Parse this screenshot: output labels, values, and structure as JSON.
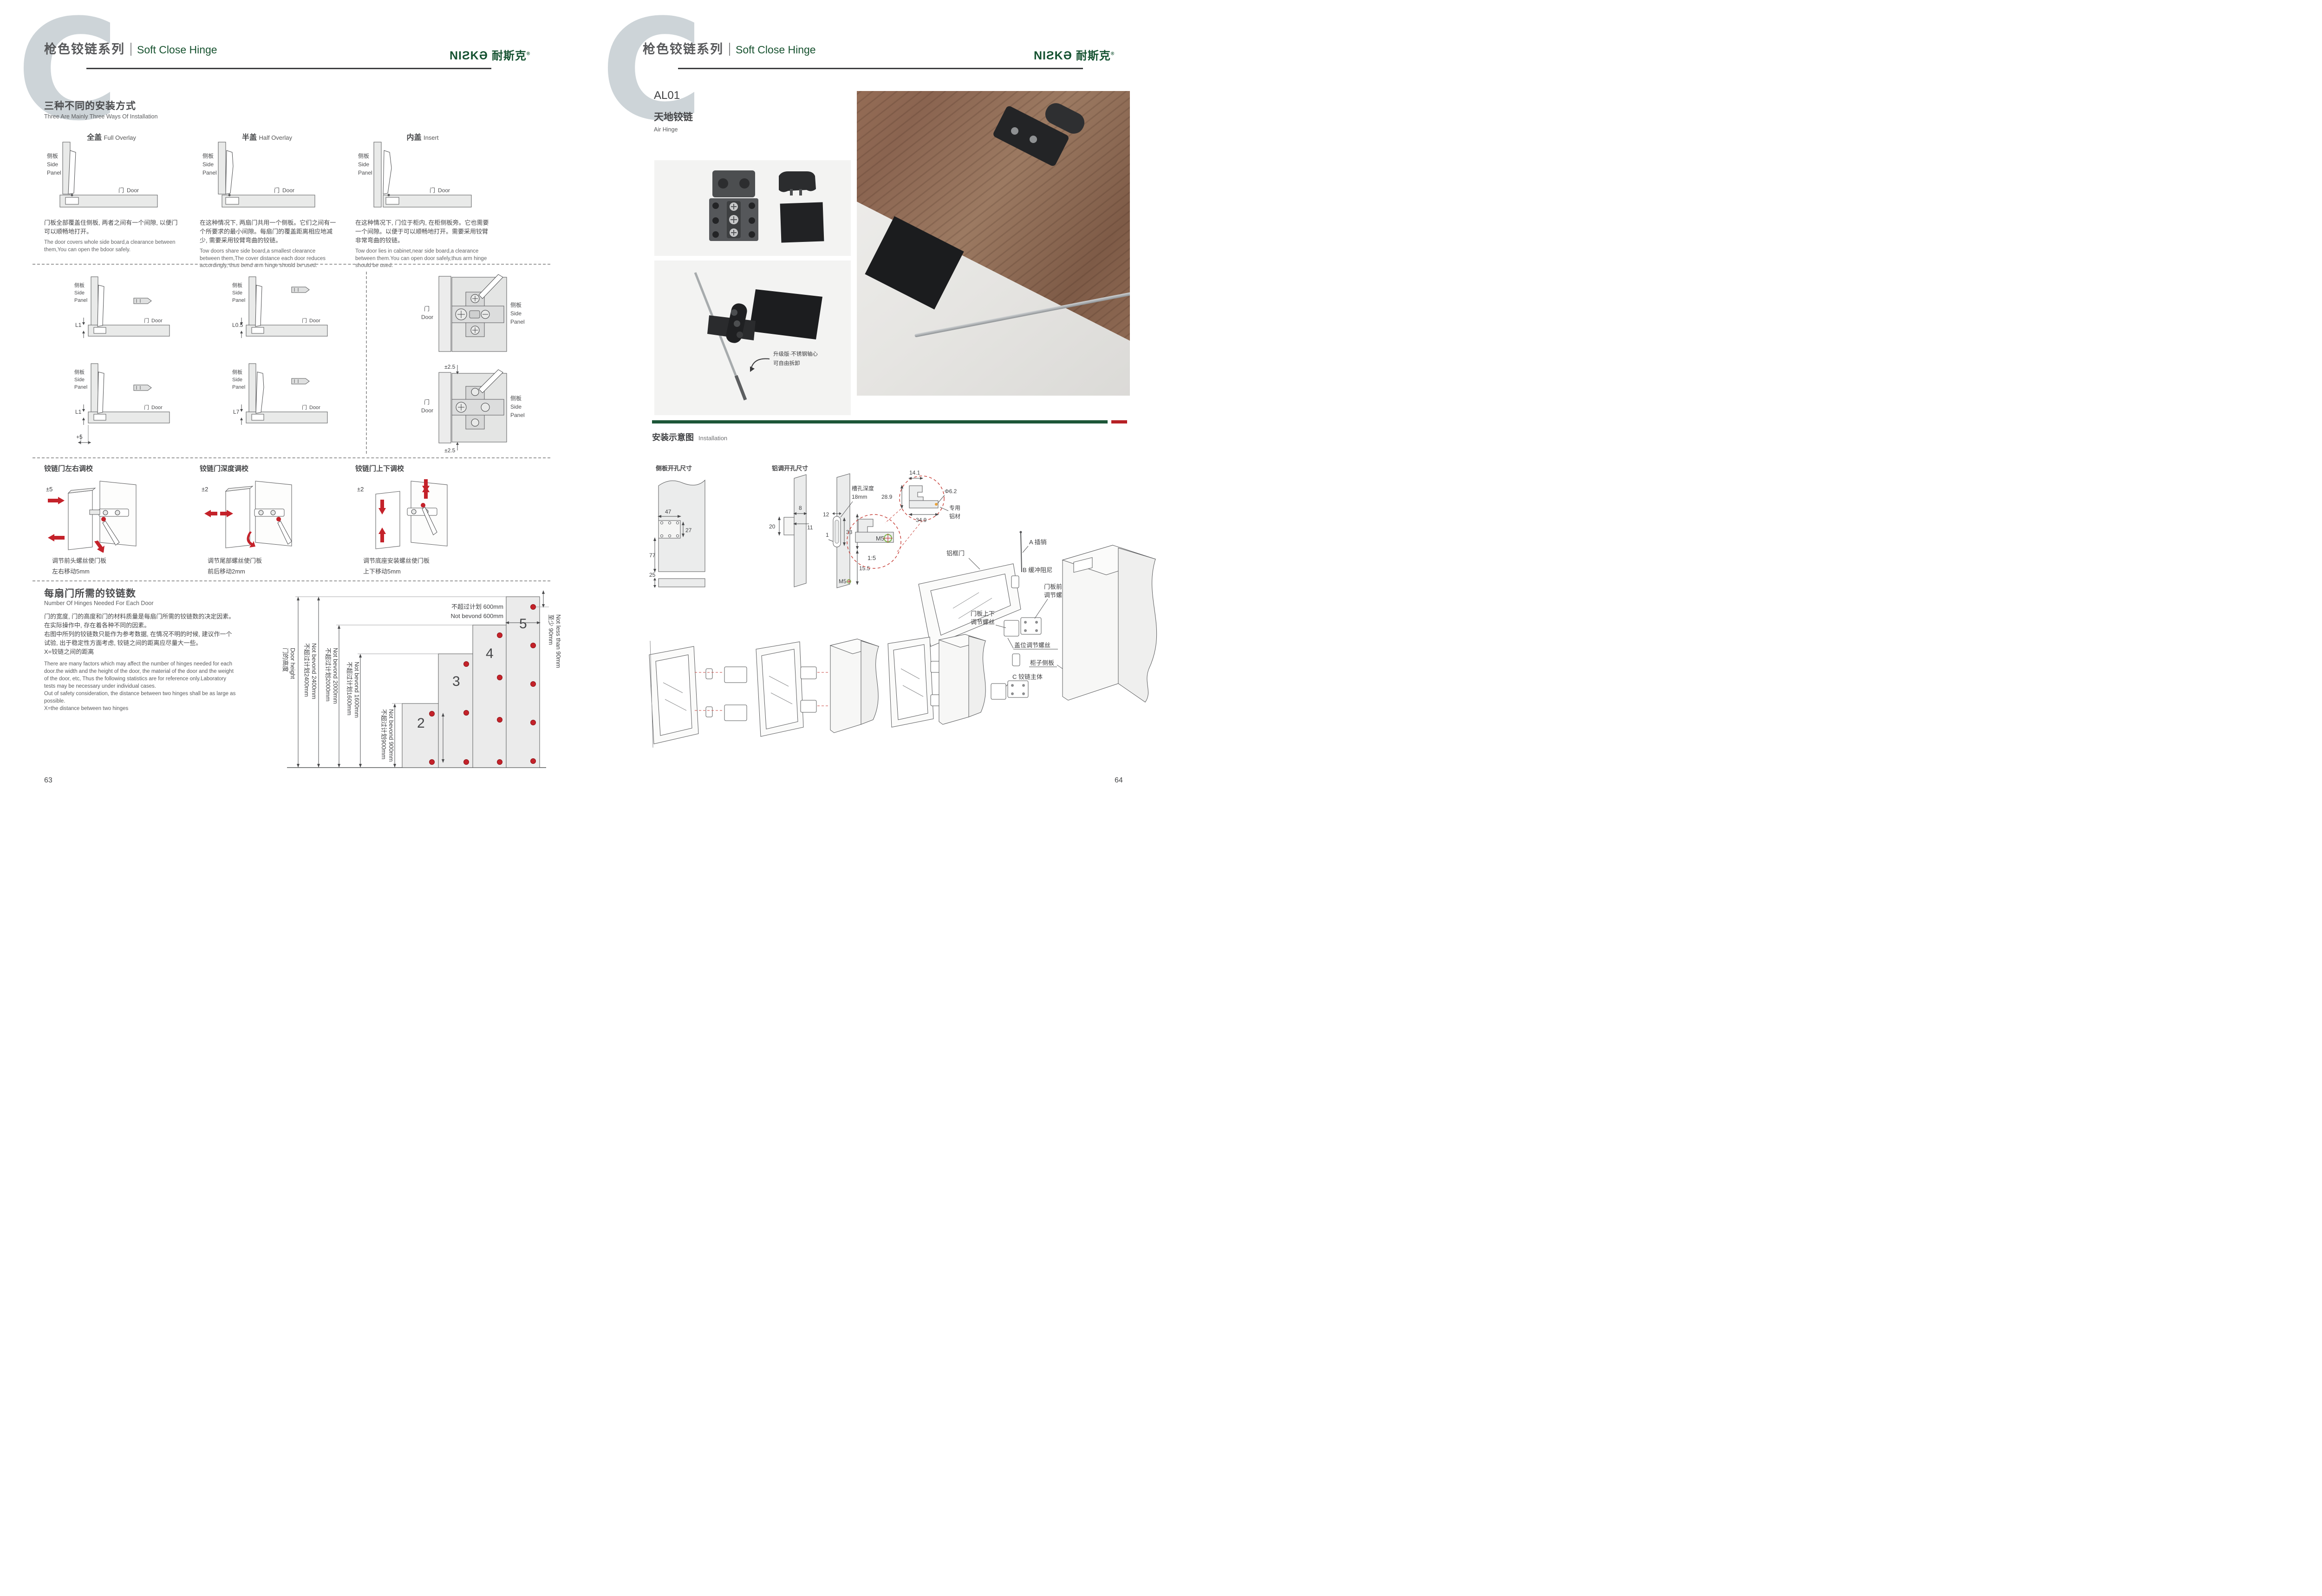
{
  "brand": {
    "logo": "NIƧKƏ",
    "logo_cn": "耐斯克",
    "registered": "®"
  },
  "header": {
    "watermark": "C",
    "series_cn": "枪色铰链系列",
    "series_en": "Soft Close Hinge"
  },
  "left": {
    "page_no": "63",
    "sec1": {
      "title_cn": "三种不同的安装方式",
      "title_en": "Three Are Mainly Three Ways Of Installation",
      "types": [
        {
          "cn": "全盖",
          "en": "Full Overlay",
          "desc_cn": "门板全部覆盖住侧板, 两者之间有一个间隙, 以便门可以顺畅地打开。",
          "desc_en": "The door covers whole side board,a clearance between them,You can open the bdoor safely."
        },
        {
          "cn": "半盖",
          "en": "Half Overlay",
          "desc_cn": "在这种情况下, 两扇门共用一个侧板。它们之间有一个所要求的最小间隙。每扇门的覆盖距离相应地减少, 需要采用铰臂弯曲的铰链。",
          "desc_en": "Tow doors share side board,a smallest clearance between them,The cover distance each door reduces accordingly, thus bend arm hinge should be used."
        },
        {
          "cn": "内盖",
          "en": "Insert",
          "desc_cn": "在这种情况下, 门位于柜内, 在柜侧板旁。它也需要一个间隙。以便于可以顺畅地打开。需要采用铰臂非常弯曲的铰链。",
          "desc_en": "Tow door lies in cabinet,near side board,a clearance between them.You can open door safely,thus arm hinge should be used."
        }
      ]
    },
    "labels": {
      "side_panel_cn": "侧板",
      "side_en1": "Side",
      "side_en2": "Panel",
      "door_cn": "门",
      "door_en": "Door"
    },
    "dims": {
      "d1": "L1",
      "d2": "L0.5",
      "d3": "L1",
      "d3b": "+5",
      "d4": "L7",
      "d5": "±2.5",
      "d6": "±2.5"
    },
    "adjust": [
      {
        "title": "铰链门左右调校",
        "value": "±5",
        "cap1": "调节前头螺丝使门板",
        "cap2": "左右移动5mm"
      },
      {
        "title": "铰链门深度调校",
        "value": "±2",
        "cap1": "调节尾部螺丝使门板",
        "cap2": "前后移动2mm"
      },
      {
        "title": "铰链门上下调校",
        "value": "±2",
        "cap1": "调节底座安装螺丝使门板",
        "cap2": "上下移动5mm"
      }
    ],
    "sec3": {
      "title_cn": "每扇门所需的铰链数",
      "title_en": "Number Of Hinges Needed For Each Door",
      "desc_cn1": "门的宽度, 门的高度和门的材料质量是每扇门所需的铰链数的决定因素。",
      "desc_cn2": "在实际操作中, 存在着各种不同的因素。",
      "desc_cn3": "右图中所列的铰链数只能作为参考数据, 在情况不明的时候, 建议作一个",
      "desc_cn4": "试验, 出于稳定性方面考虑, 铰链之间的距离应尽量大一些。",
      "desc_cn5": "X=铰链之间的距离",
      "desc_en1": "There are many factors which may affect the number of hinges needed for each",
      "desc_en2": "door.the width and the height of the door, the material of the door and the weight",
      "desc_en3": "of the door, etc, Thus the following statistics are for reference only.Laboratory",
      "desc_en4": "tests may be necessary under individual cases.",
      "desc_en5": "Out of safety consideration, the distance between two hinges shall be as large as",
      "desc_en6": "possible.",
      "desc_en7": "X=the distance between two hinges"
    }
  },
  "chart": {
    "door_h_cn": "门的高度",
    "door_h_en": "Door height",
    "h2400_cn": "不超过计划2400mm",
    "h2400_en": "Not bevond 2400mm",
    "h2000_cn": "不超过计划2000mm",
    "h2000_en": "Not bevond 2000mm",
    "h1600_cn": "不超过计划1600mm",
    "h1600_en": "Not bevond 1600mm",
    "h900_cn": "不超过计划900mm",
    "h900_en": "Not bevond 900mm",
    "w600_cn": "不超过计划 600mm",
    "w600_en": "Not bevond 600mm",
    "min90_cn": "至少 90mm",
    "min90_en": "Not less than 90mm",
    "n2": "2",
    "n3": "3",
    "n4": "4",
    "n5": "5"
  },
  "chart_data": {
    "type": "bar",
    "title": "每扇门所需的铰链数 / Number Of Hinges Needed For Each Door",
    "categories": [
      "2 hinges",
      "3 hinges",
      "4 hinges",
      "5 hinges"
    ],
    "values_max_door_height_mm": [
      900,
      1600,
      2000,
      2400
    ],
    "max_door_width_mm": 600,
    "min_top_hinge_distance_mm": 90,
    "ylabel": "门的高度 Door height (mm)",
    "ylim": [
      0,
      2400
    ],
    "annotations": [
      "不超过计划 600mm Not bevond 600mm",
      "至少 90mm Not less than 90mm",
      "X=铰链之间的距离 X=the distance between two hinges"
    ]
  },
  "right": {
    "page_no": "64",
    "product": {
      "code": "AL01",
      "name_cn": "天地铰链",
      "name_en": "Air Hinge"
    },
    "photo_note1": "升级版·不锈钢轴心",
    "photo_note2": "可自由拆卸",
    "install": {
      "title_cn": "安装示意图",
      "title_en": "Installation"
    },
    "drill": {
      "side_title": "侧板开孔尺寸",
      "alu_title": "铝调开孔尺寸",
      "d47": "47",
      "d27": "27",
      "d77": "77",
      "d25": "25",
      "d8": "8",
      "d20": "20",
      "d11": "11",
      "d12": "12",
      "d1": "1",
      "d33": "33",
      "d46": "46",
      "d155": "15.5",
      "m5a": "M5",
      "slot1": "槽孔深度",
      "slot2": "18mm",
      "d141": "14.1",
      "d289": "28.9",
      "d349": "34.9",
      "dia": "Φ6.2",
      "alu1": "专用",
      "alu2": "铝材",
      "m5b": "M5",
      "scale": "1:5"
    },
    "exploded": {
      "alu_door": "铝框门",
      "pin": "A 插销",
      "damper": "B 缓冲阻尼",
      "fb1": "门板前后",
      "fb2": "调节螺丝",
      "ud1": "门板上下",
      "ud2": "调节螺丝",
      "cover": "盖位调节螺丝",
      "side": "柜子侧板",
      "body": "C 铰链主体"
    }
  }
}
